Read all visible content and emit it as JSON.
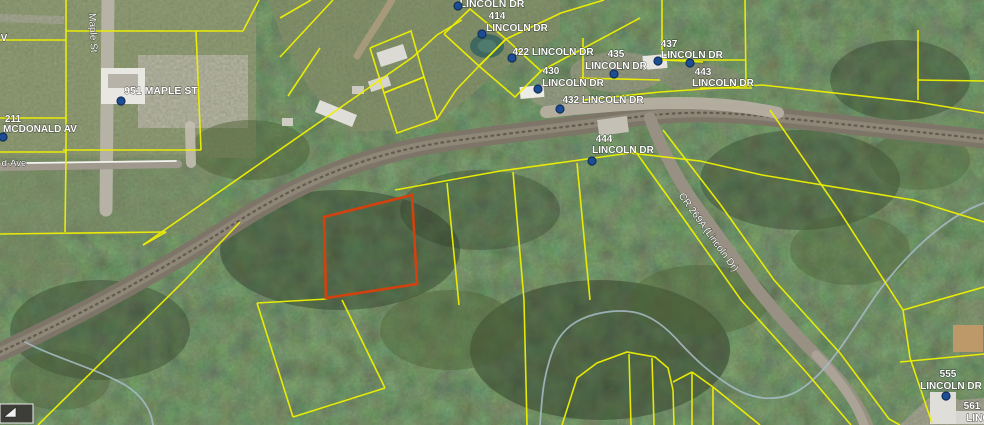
{
  "map": {
    "description": "Aerial parcel map with highlighted parcel",
    "colors": {
      "parcel_line": "#eef000",
      "selected_parcel": "#d5410e",
      "marker_fill": "#1d4e94",
      "marker_ring": "#122f59",
      "label_text": "#ffffff",
      "forest_base": "#34422b"
    },
    "labels": [
      {
        "id": "lincoln-dr-top",
        "text": "LINCOLN DR",
        "x": 492,
        "y": 7,
        "rot": 0,
        "size": 10.5,
        "bold": true
      },
      {
        "id": "addr-414",
        "text": "414",
        "x": 497,
        "y": 19,
        "rot": 0,
        "size": 10,
        "bold": true
      },
      {
        "id": "addr-414-street",
        "text": "LINCOLN DR",
        "x": 517,
        "y": 31,
        "rot": 0,
        "size": 10,
        "bold": true
      },
      {
        "id": "addr-422",
        "text": "422 LINCOLN DR",
        "x": 553,
        "y": 55,
        "rot": 0,
        "size": 10,
        "bold": true
      },
      {
        "id": "addr-430",
        "text": "430",
        "x": 551,
        "y": 74,
        "rot": 0,
        "size": 10,
        "bold": true
      },
      {
        "id": "addr-430-street",
        "text": "LINCOLN DR",
        "x": 573,
        "y": 86,
        "rot": 0,
        "size": 10,
        "bold": true
      },
      {
        "id": "addr-435",
        "text": "435",
        "x": 616,
        "y": 57,
        "rot": 0,
        "size": 10,
        "bold": true
      },
      {
        "id": "addr-435-street",
        "text": "LINCOLN DR",
        "x": 616,
        "y": 69,
        "rot": 0,
        "size": 10,
        "bold": true
      },
      {
        "id": "addr-437",
        "text": "437",
        "x": 669,
        "y": 47,
        "rot": 0,
        "size": 10,
        "bold": true
      },
      {
        "id": "addr-437-street",
        "text": "LINCOLN DR",
        "x": 692,
        "y": 58,
        "rot": 0,
        "size": 10,
        "bold": true
      },
      {
        "id": "addr-443",
        "text": "443",
        "x": 703,
        "y": 75,
        "rot": 0,
        "size": 10,
        "bold": true
      },
      {
        "id": "addr-443-street",
        "text": "LINCOLN DR",
        "x": 723,
        "y": 86,
        "rot": 0,
        "size": 10,
        "bold": true
      },
      {
        "id": "addr-432",
        "text": "432 LINCOLN DR",
        "x": 603,
        "y": 103,
        "rot": 0,
        "size": 10,
        "bold": true
      },
      {
        "id": "addr-444",
        "text": "444",
        "x": 604,
        "y": 142,
        "rot": 0,
        "size": 10,
        "bold": true
      },
      {
        "id": "addr-444-street",
        "text": "LINCOLN DR",
        "x": 623,
        "y": 153,
        "rot": 0,
        "size": 10,
        "bold": true
      },
      {
        "id": "addr-951",
        "text": "951 MAPLE ST",
        "x": 161,
        "y": 94,
        "rot": 0,
        "size": 10.5,
        "bold": true
      },
      {
        "id": "addr-211",
        "text": "211",
        "x": 13,
        "y": 122,
        "rot": 0,
        "size": 10,
        "bold": true
      },
      {
        "id": "addr-211-street",
        "text": "MCDONALD AV",
        "x": 40,
        "y": 132,
        "rot": 0,
        "size": 10,
        "bold": true
      },
      {
        "id": "addr-555",
        "text": "555",
        "x": 948,
        "y": 377,
        "rot": 0,
        "size": 10,
        "bold": true
      },
      {
        "id": "addr-555-street",
        "text": "LINCOLN DR",
        "x": 951,
        "y": 389,
        "rot": 0,
        "size": 10,
        "bold": true
      },
      {
        "id": "addr-561",
        "text": "561",
        "x": 972,
        "y": 409,
        "rot": 0,
        "size": 10,
        "bold": true
      },
      {
        "id": "addr-561-street",
        "text": "LINC",
        "x": 978,
        "y": 421,
        "rot": 0,
        "size": 10,
        "bold": true
      },
      {
        "id": "label-v-cut",
        "text": "V",
        "x": 4,
        "y": 41,
        "rot": 0,
        "size": 10,
        "bold": true
      },
      {
        "id": "street-mcdonald-ave",
        "text": "d-Ave",
        "x": 14,
        "y": 166,
        "rot": 0,
        "size": 9.5,
        "bold": false
      },
      {
        "id": "street-maple-st",
        "text": "Maple St",
        "x": 90,
        "y": 33,
        "rot": 87,
        "size": 10,
        "bold": false
      },
      {
        "id": "street-cr269a",
        "text": "CR 269A (Lincoln Dr)",
        "x": 706,
        "y": 234,
        "rot": 54,
        "size": 10,
        "bold": false
      }
    ],
    "markers": [
      {
        "x": 458,
        "y": 6
      },
      {
        "x": 482,
        "y": 34
      },
      {
        "x": 512,
        "y": 58
      },
      {
        "x": 538,
        "y": 89
      },
      {
        "x": 614,
        "y": 74
      },
      {
        "x": 658,
        "y": 61
      },
      {
        "x": 690,
        "y": 63
      },
      {
        "x": 560,
        "y": 109
      },
      {
        "x": 592,
        "y": 161
      },
      {
        "x": 121,
        "y": 101
      },
      {
        "x": 3,
        "y": 137
      },
      {
        "x": 946,
        "y": 396
      }
    ],
    "selected_parcel": {
      "points": "324,217 412,195 417,284 326,298"
    },
    "parcel_lines": [
      "66,0 66,158",
      "0,40 66,40",
      "0,118 66,118",
      "0,152 66,152",
      "66,31 243,31",
      "243,31 259,0",
      "63,150 201,150",
      "196,31 201,150",
      "66,158 65,232",
      "0,234 166,232",
      "166,232 143,245",
      "143,245 413,57",
      "413,57 437,35 462,20",
      "280,57 333,0",
      "280,18 311,0",
      "288,96 320,48",
      "370,48 411,31 424,77 384,93 370,48",
      "384,93 424,77 437,119 397,133 384,93",
      "444,34 470,9 506,39 479,66 444,34",
      "479,66 506,39 541,71 515,97 479,66",
      "437,119 456,90 479,66",
      "506,39 561,13 604,0",
      "541,71 640,18",
      "583,38 583,78",
      "580,78 660,80",
      "662,0 662,60",
      "662,60 703,62",
      "745,0 746,86",
      "662,60 746,60",
      "700,88 752,88",
      "583,100 660,92 762,85 917,102 984,113",
      "918,30 918,100",
      "918,80 984,81",
      "395,190 500,171 630,153 700,161 762,175 913,200 984,222",
      "633,148 686,222 741,300 806,372 851,425",
      "663,130 720,204 774,280 840,353 889,419 900,425",
      "903,310 984,287",
      "903,310 910,358",
      "910,358 932,423",
      "900,362 984,354",
      "770,110 840,212 903,310",
      "447,183 459,305",
      "513,172 524,300 527,425",
      "577,163 590,300",
      "257,303 293,417",
      "293,417 385,388",
      "385,388 342,300",
      "257,303 327,299",
      "240,222 185,280 38,425",
      "562,425 570,400 577,378 597,363 627,352 655,357 668,368 673,390 674,425",
      "629,354 631,425",
      "652,358 654,425",
      "673,382 692,372",
      "692,372 692,425",
      "692,372 713,387",
      "713,387 713,425",
      "713,387 760,425"
    ],
    "roads": [
      {
        "name": "maple-st-road",
        "d": "M 108,0 L 106,210",
        "stroke": "#b6b2a6",
        "w": 13,
        "o": 1
      },
      {
        "name": "mcdonald-ave-road",
        "d": "M 0,167 L 178,164",
        "stroke": "#9f9a8d",
        "w": 8,
        "o": 1
      },
      {
        "name": "rail-corridor",
        "d": "M 0,352 C 80,315 160,272 240,220 C 310,176 380,150 460,140 C 540,129 580,126 622,119 C 680,110 725,112 772,117 C 850,125 920,132 984,139",
        "stroke": "#7d7668",
        "w": 19,
        "o": 1
      },
      {
        "name": "rail-corridor-inner",
        "d": "M 0,352 C 80,315 160,272 240,220 C 310,176 380,150 460,140 C 540,129 580,126 622,119 C 680,110 725,112 772,117 C 850,125 920,132 984,139",
        "stroke": "#90897a",
        "w": 9,
        "o": 0.85
      },
      {
        "name": "rail-track",
        "d": "M 0,352 C 80,315 160,272 240,220 C 310,176 380,150 460,140 C 540,129 580,126 622,119 C 680,110 725,112 772,117 C 850,125 920,132 984,139",
        "stroke": "#5d574c",
        "w": 2.2,
        "o": 0.9,
        "dash": "1.8 4.5"
      },
      {
        "name": "lincoln-dr-pavement",
        "d": "M 546,112 C 600,106 640,103 678,103 C 715,103 745,106 778,113",
        "stroke": "#b6afa1",
        "w": 12,
        "o": 0.95
      },
      {
        "name": "cr269a-road",
        "d": "M 650,118 C 662,150 680,185 701,212 C 726,247 741,267 756,288 C 786,325 806,345 824,363 C 846,386 859,406 867,425",
        "stroke": "#989183",
        "w": 12,
        "o": 1
      },
      {
        "name": "cr269a-road-light",
        "d": "M 816,355 C 838,378 856,402 864,425",
        "stroke": "#ada698",
        "w": 9,
        "o": 0.9
      },
      {
        "name": "driveway-top",
        "d": "M 392,0 C 380,20 368,38 357,56",
        "stroke": "#ab9b7c",
        "w": 7,
        "o": 0.9
      },
      {
        "name": "driveway-951",
        "d": "M 190,126 L 191,163",
        "stroke": "#c3beaf",
        "w": 10,
        "o": 0.9
      },
      {
        "name": "mcdonald-ave-centerline",
        "d": "M 27,163 L 176,161",
        "stroke": "#f4f4f0",
        "w": 1.8,
        "o": 1
      },
      {
        "name": "stream-southwest",
        "d": "M 25,342 C 55,358 95,368 125,385 C 140,394 151,408 153,425",
        "stroke": "#a3b8c0",
        "w": 1.8,
        "o": 0.9
      },
      {
        "name": "stream-main",
        "d": "M 540,425 C 542,398 543,382 549,362 C 554,344 561,331 576,322 C 591,313 615,309 633,312 C 652,315 669,330 681,344 C 696,360 707,370 723,381 C 739,392 749,396 763,398 C 786,400 801,392 819,374 C 839,354 859,319 879,291 C 894,271 916,246 941,227 C 959,213 973,207 984,203",
        "stroke": "#a3b8c0",
        "w": 1.8,
        "o": 0.9
      }
    ],
    "buildings": [
      {
        "name": "house-951",
        "x": 101,
        "y": 68,
        "w": 44,
        "h": 36,
        "rot": 0,
        "fill": "#e9e7e1"
      },
      {
        "name": "house-951-roof",
        "x": 108,
        "y": 74,
        "w": 30,
        "h": 14,
        "rot": 0,
        "fill": "#b7b3a9"
      },
      {
        "name": "trailer-1",
        "x": 378,
        "y": 48,
        "w": 28,
        "h": 15,
        "rot": -18,
        "fill": "#dcdad4"
      },
      {
        "name": "trailer-2",
        "x": 369,
        "y": 78,
        "w": 21,
        "h": 11,
        "rot": -18,
        "fill": "#d6d4ce"
      },
      {
        "name": "trailer-3",
        "x": 316,
        "y": 107,
        "w": 40,
        "h": 13,
        "rot": 22,
        "fill": "#e0ded8"
      },
      {
        "name": "shed-1",
        "x": 352,
        "y": 86,
        "w": 12,
        "h": 8,
        "rot": 0,
        "fill": "#ccc9c1"
      },
      {
        "name": "shed-2",
        "x": 282,
        "y": 118,
        "w": 11,
        "h": 8,
        "rot": 0,
        "fill": "#cfccc4"
      },
      {
        "name": "trailer-437",
        "x": 643,
        "y": 55,
        "w": 24,
        "h": 14,
        "rot": -5,
        "fill": "#e6e4de"
      },
      {
        "name": "building-435",
        "x": 598,
        "y": 118,
        "w": 30,
        "h": 16,
        "rot": -8,
        "fill": "#c4c0b6"
      },
      {
        "name": "building-432",
        "x": 520,
        "y": 86,
        "w": 24,
        "h": 12,
        "rot": -5,
        "fill": "#edebe5"
      },
      {
        "name": "house-555",
        "x": 930,
        "y": 392,
        "w": 26,
        "h": 32,
        "rot": 0,
        "fill": "#e0ded8"
      },
      {
        "name": "house-561",
        "x": 956,
        "y": 411,
        "w": 28,
        "h": 13,
        "rot": 0,
        "fill": "#d7d5cf"
      },
      {
        "name": "tan-roof-house",
        "x": 953,
        "y": 325,
        "w": 30,
        "h": 27,
        "rot": 0,
        "fill": "#bd9868"
      }
    ],
    "pond": {
      "cx": 487,
      "cy": 46,
      "rx": 17,
      "ry": 12,
      "fill": "#40685e",
      "inner_fill": "#4f7a6e"
    },
    "widget": {
      "box": {
        "x": 0,
        "y": 404,
        "w": 33,
        "h": 19,
        "fill": "#3e3e38",
        "stroke": "#e9e9e9"
      },
      "tri": "M4,417 L16,407 L16,417 Z",
      "tri_fill": "#f0f0f0"
    }
  }
}
